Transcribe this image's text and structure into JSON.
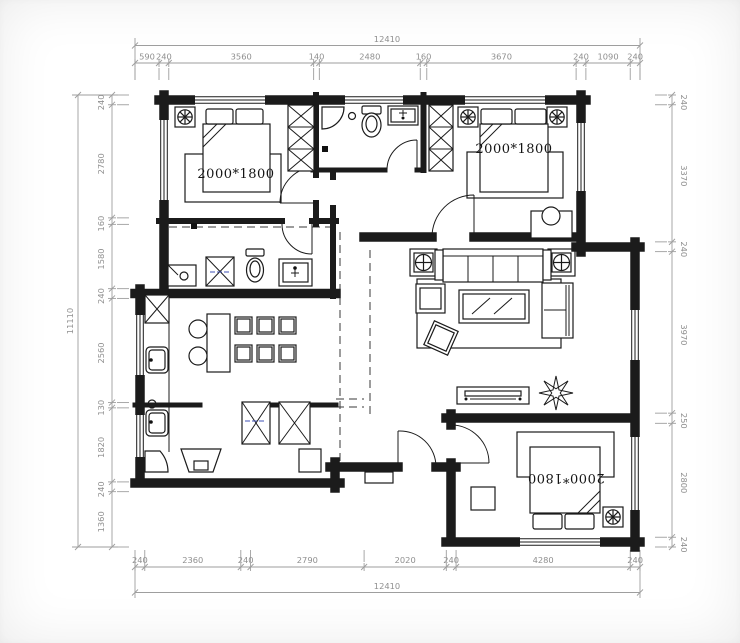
{
  "title": "residential floor plan drawing",
  "colors": {
    "wall": "#1b1b1b",
    "dimension_line": "#9e9e9e",
    "dimension_text": "#8f8f8f",
    "annotation_blue": "#3f51b5",
    "background": "#ffffff"
  },
  "labels": {
    "bed_top_left": "2000*1800",
    "bed_top_right": "2000*1800",
    "bed_bottom_right": "2000*1800"
  },
  "dimensions": {
    "top": {
      "overall": "12410",
      "segments": [
        590,
        240,
        3560,
        140,
        2480,
        160,
        3670,
        240,
        1090,
        240
      ]
    },
    "bottom": {
      "overall": "12410",
      "segments": [
        240,
        2360,
        240,
        2790,
        2020,
        240,
        4280,
        240
      ]
    },
    "left": {
      "overall": "11110",
      "segments": [
        240,
        2780,
        160,
        1580,
        240,
        2560,
        130,
        1820,
        240,
        1360
      ]
    },
    "right": {
      "segments": [
        240,
        3370,
        240,
        3970,
        250,
        2800,
        240
      ]
    }
  }
}
